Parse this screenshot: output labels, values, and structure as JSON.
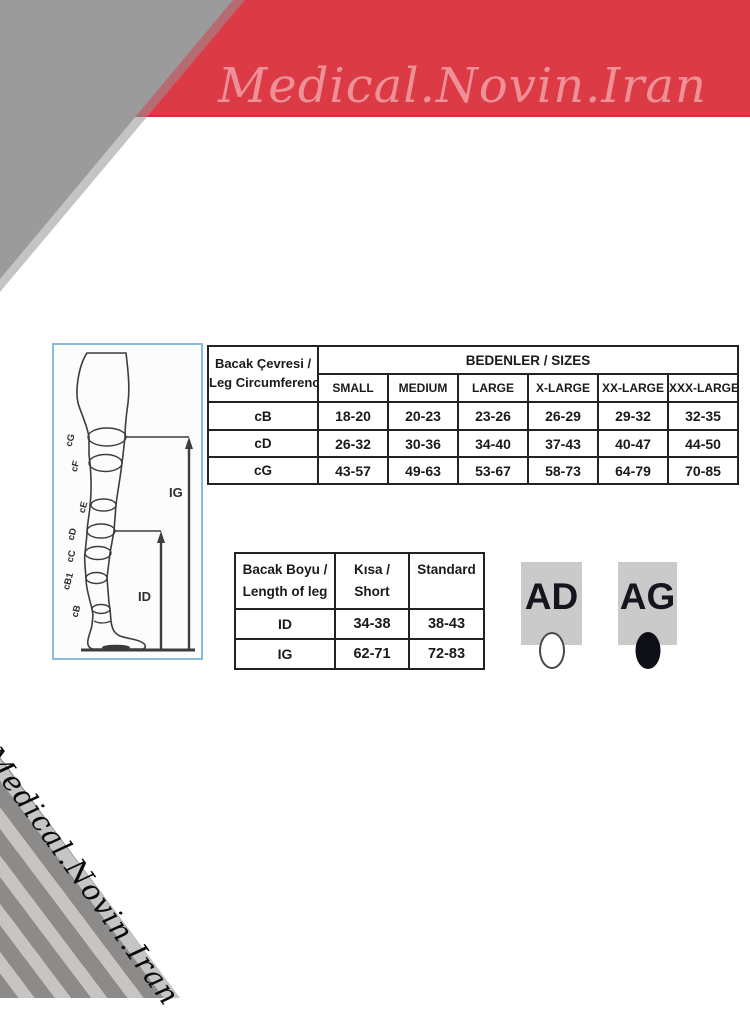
{
  "colors": {
    "banner_red": "#dc3b46",
    "banner_text_pink": "#ee9097",
    "corner_gray": "#9b9b9b",
    "stripe_light_gray": "#c7c5c3",
    "stripe_dark_gray": "#8d8b89",
    "diagram_border_blue": "#88bcdb",
    "badge_gray": "#cacaca",
    "table_border": "#222222"
  },
  "banner": {
    "title": "Medical.Novin.Iran"
  },
  "watermark": {
    "text": "Medical.Novin.Iran"
  },
  "leg_diagram": {
    "circumference_labels": [
      "cG",
      "cF",
      "cE",
      "cD",
      "cC",
      "cB1",
      "cB"
    ],
    "ig_label": "IG",
    "id_label": "ID"
  },
  "size_table": {
    "row_header_line1": "Bacak Çevresi /",
    "row_header_line2": "Leg Circumference",
    "group_header": "BEDENLER / SIZES",
    "columns": [
      "SMALL",
      "MEDIUM",
      "LARGE",
      "X-LARGE",
      "XX-LARGE",
      "XXX-LARGE"
    ],
    "rows": [
      {
        "label": "cB",
        "values": [
          "18-20",
          "20-23",
          "23-26",
          "26-29",
          "29-32",
          "32-35"
        ]
      },
      {
        "label": "cD",
        "values": [
          "26-32",
          "30-36",
          "34-40",
          "37-43",
          "40-47",
          "44-50"
        ]
      },
      {
        "label": "cG",
        "values": [
          "43-57",
          "49-63",
          "53-67",
          "58-73",
          "64-79",
          "70-85"
        ]
      }
    ]
  },
  "length_table": {
    "row_header_line1": "Bacak Boyu /",
    "row_header_line2": "Length of leg",
    "col_short_line1": "Kısa /",
    "col_short_line2": "Short",
    "col_standard": "Standard",
    "rows": [
      {
        "label": "ID",
        "short": "34-38",
        "standard": "38-43"
      },
      {
        "label": "IG",
        "short": "62-71",
        "standard": "72-83"
      }
    ]
  },
  "badges": [
    {
      "label": "AD",
      "dot": "white"
    },
    {
      "label": "AG",
      "dot": "black"
    }
  ]
}
